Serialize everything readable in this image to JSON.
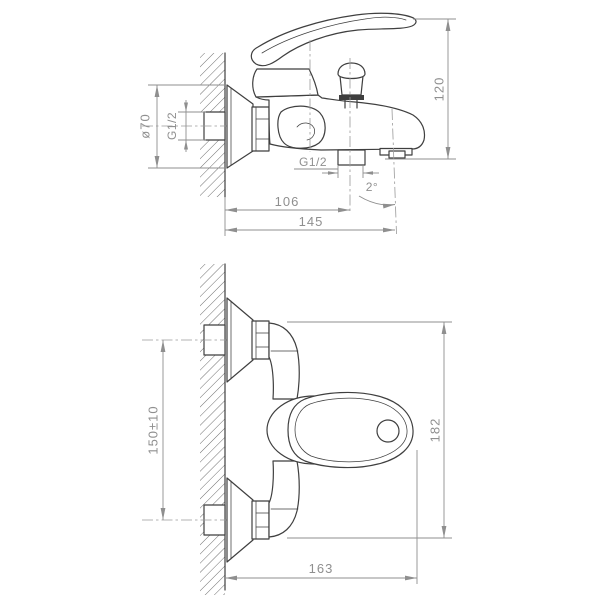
{
  "colors": {
    "background": "#ffffff",
    "object_line": "#3f3f3f",
    "dimension_line": "#8f8f8f",
    "dimension_text": "#8f8f8f"
  },
  "side_view": {
    "dims": {
      "escutcheon_diameter": "ø70",
      "wall_thread": "G1/2",
      "height": "120",
      "outlet_thread": "G1/2",
      "spout_angle": "2°",
      "wall_to_outlet": "106",
      "wall_to_spout_end": "145"
    }
  },
  "plan_view": {
    "dims": {
      "hole_spacing": "150±10",
      "overall_span": "182",
      "wall_to_handle_tip": "163"
    }
  }
}
